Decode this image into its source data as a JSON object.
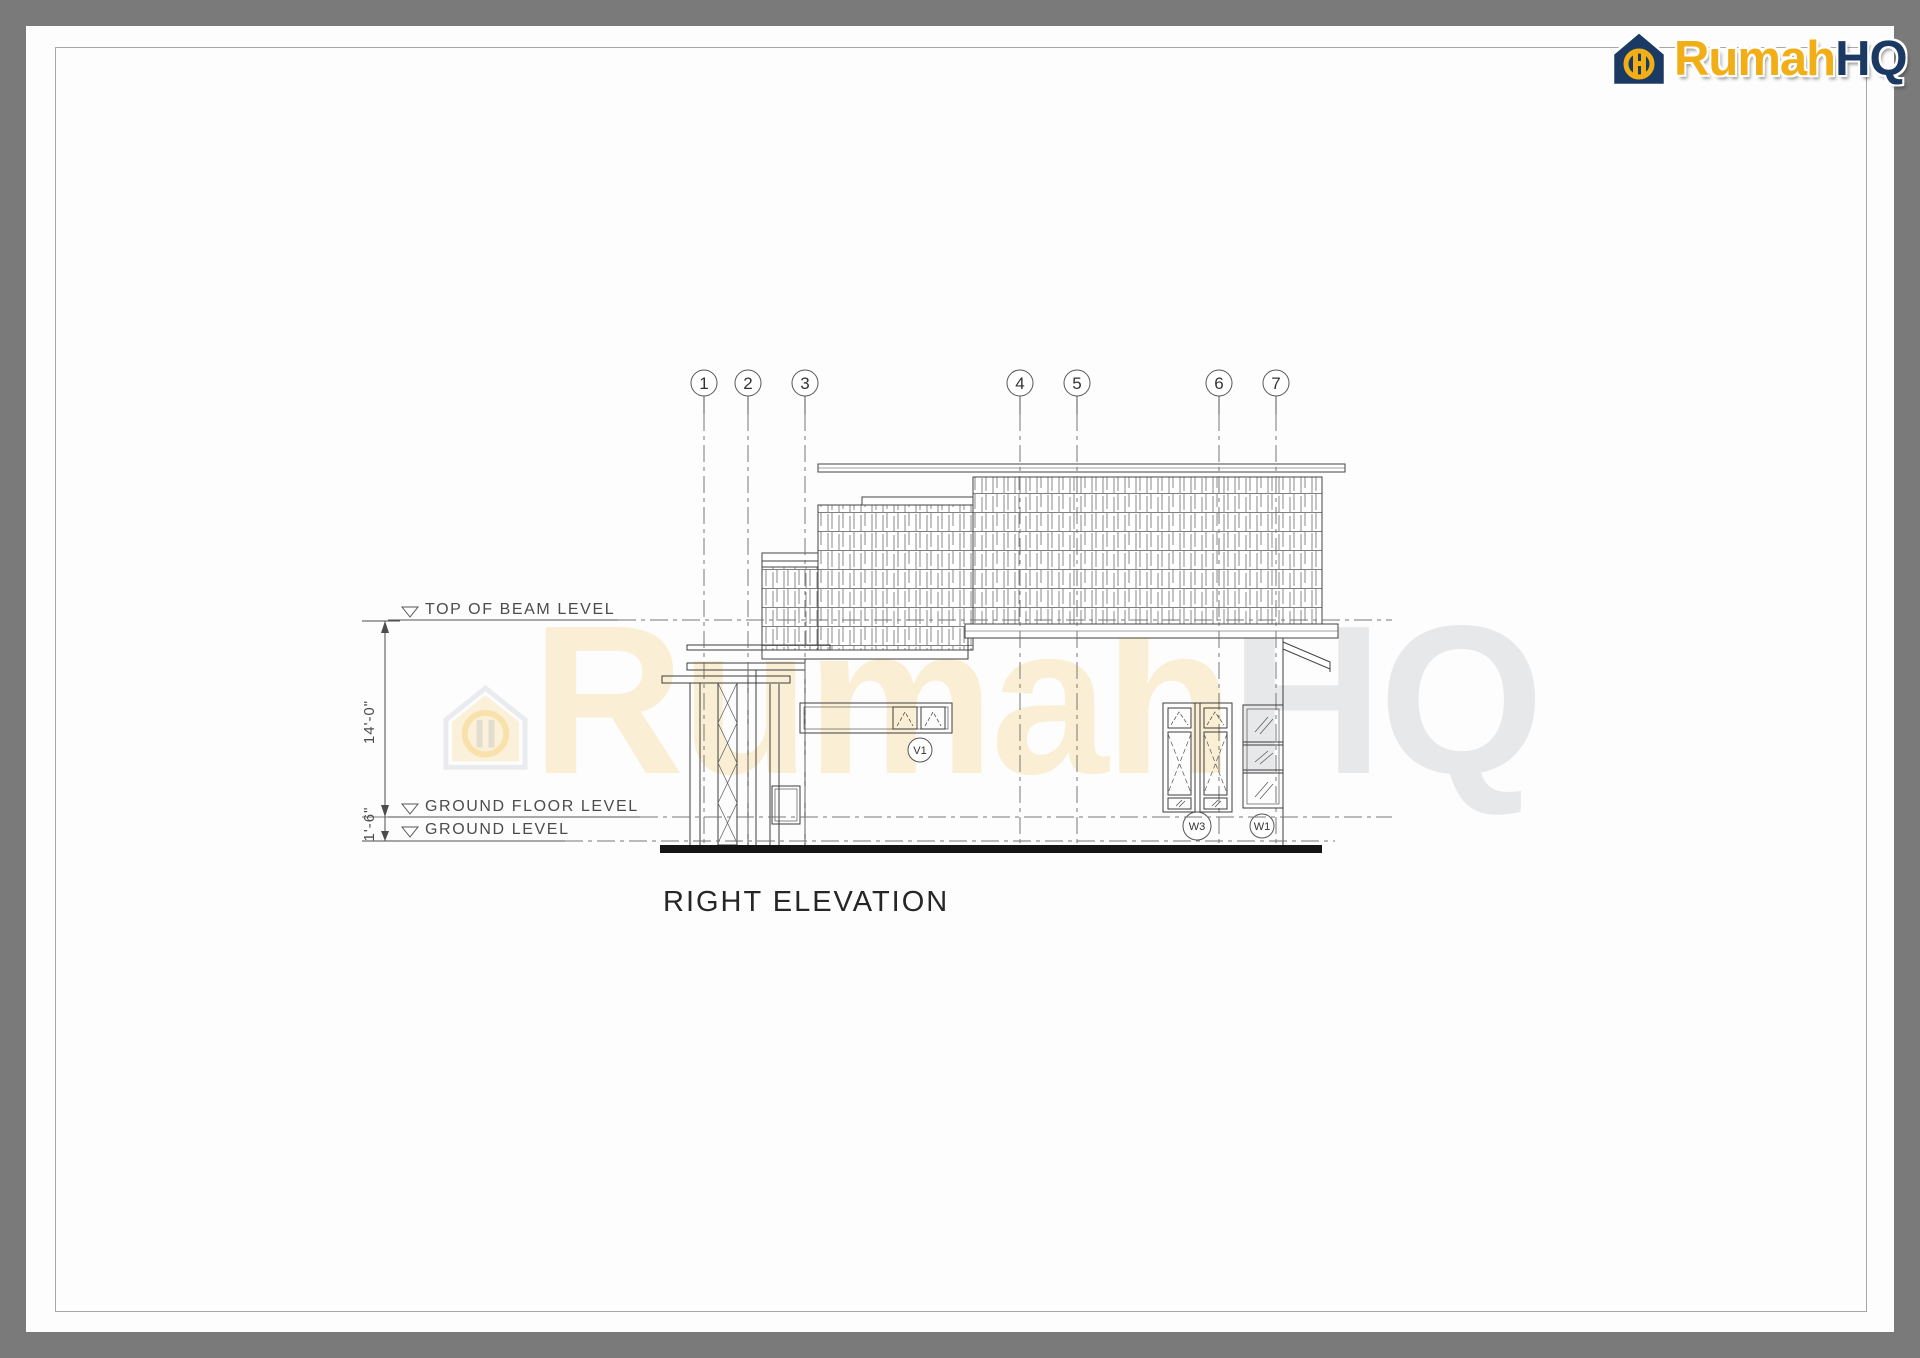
{
  "page": {
    "background_color": "#7a7a7a",
    "paper_color": "#fdfdfd",
    "border_color": "#a8a8a8"
  },
  "logo": {
    "brand_rumah": "Rumah",
    "brand_hq": "HQ",
    "gold": "#f2ae17",
    "navy": "#1b3a63"
  },
  "watermark": {
    "rumah": "Rumah",
    "hq": "HQ"
  },
  "drawing": {
    "title": "RIGHT ELEVATION",
    "grid_bubbles": [
      {
        "label": "1"
      },
      {
        "label": "2"
      },
      {
        "label": "3"
      },
      {
        "label": "4"
      },
      {
        "label": "5"
      },
      {
        "label": "6"
      },
      {
        "label": "7"
      }
    ],
    "levels": [
      {
        "label": "TOP OF BEAM LEVEL"
      },
      {
        "label": "GROUND FLOOR LEVEL"
      },
      {
        "label": "GROUND LEVEL"
      }
    ],
    "dimensions": [
      {
        "label": "14'-0\""
      },
      {
        "label": "1'-6\""
      }
    ],
    "window_tags": [
      {
        "label": "V1"
      },
      {
        "label": "W3"
      },
      {
        "label": "W1"
      }
    ]
  }
}
